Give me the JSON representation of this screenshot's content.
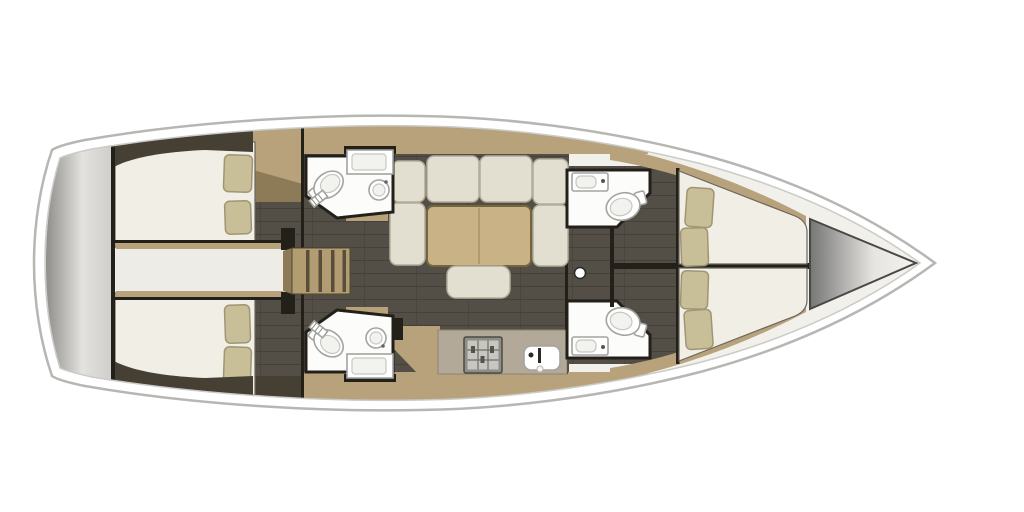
{
  "scene": {
    "type": "floorplan",
    "subject": "sailing-yacht interior, top-down view",
    "orientation": {
      "bow": "right",
      "stern": "left"
    },
    "visible_text": ""
  },
  "colors": {
    "hull_stroke": "#b6b6b2",
    "rim_stroke": "#cbcbc7",
    "interior_base": "#f2f0ea",
    "wood": "#b7a27b",
    "wood_dark": "#8d7a57",
    "wood_edge": "#8a7a58",
    "floor_dark": "#534e46",
    "floor_line": "#45403a",
    "wall_dark": "#23201a",
    "hull_wedge": "#463f34",
    "mattress": "#f0eee5",
    "mattress_stroke": "#6b665c",
    "pillow": "#c8bf99",
    "pillow_stroke": "#9e9674",
    "cushion": "#e3dfd0",
    "cushion_stroke": "#b2ad9b",
    "table_wood": "#c9b285",
    "table_edge": "#75653f",
    "counter": "#b3a998",
    "counter_edge": "#8d8476",
    "fixture_white": "#fcfcfa",
    "fixture_stroke": "#a3a39f",
    "stairs": "#b29d72",
    "stairs_tread": "#4a4031",
    "corridor_white": "#edece6",
    "stern_gradient": [
      "#8f8e8b",
      "#e3e2df",
      "#cfcecb"
    ],
    "bow_gradient": [
      "#767674",
      "#e6e5e2",
      "#f3f2f0"
    ]
  },
  "areas": [
    {
      "id": "swim-platform",
      "label": "stern swim platform"
    },
    {
      "id": "aft-cabin-top",
      "label": "aft double cabin (top) with 2 pillows"
    },
    {
      "id": "aft-cabin-bottom",
      "label": "aft double cabin (bottom) with 2 pillows"
    },
    {
      "id": "engine-passage",
      "label": "central passage between aft cabins"
    },
    {
      "id": "companionway",
      "label": "companionway steps"
    },
    {
      "id": "head-aft-top",
      "label": "aft head with shower, toilet, round sink (top)"
    },
    {
      "id": "head-aft-bottom",
      "label": "aft head with shower, toilet, round sink (bottom)"
    },
    {
      "id": "salon",
      "label": "salon with U-shaped settee, table and ottoman"
    },
    {
      "id": "galley",
      "label": "galley with stove and sink"
    },
    {
      "id": "head-fwd-top",
      "label": "forward head with toilet and sink (top)"
    },
    {
      "id": "head-fwd-bottom",
      "label": "forward head with toilet and sink (bottom)"
    },
    {
      "id": "fwd-berth-top",
      "label": "forward berth (top) with 2 pillows"
    },
    {
      "id": "fwd-berth-bottom",
      "label": "forward berth (bottom) with 2 pillows"
    },
    {
      "id": "bow-locker",
      "label": "bow anchor locker"
    }
  ],
  "fixtures": {
    "toilets": 4,
    "head_sinks": 4,
    "galley_sink": 1,
    "showers": 2,
    "stove": 1,
    "beds": 4,
    "pillows": 8,
    "salon_table": 1,
    "ottoman": 1,
    "mast_post": 1,
    "companionway_treads": 4
  }
}
